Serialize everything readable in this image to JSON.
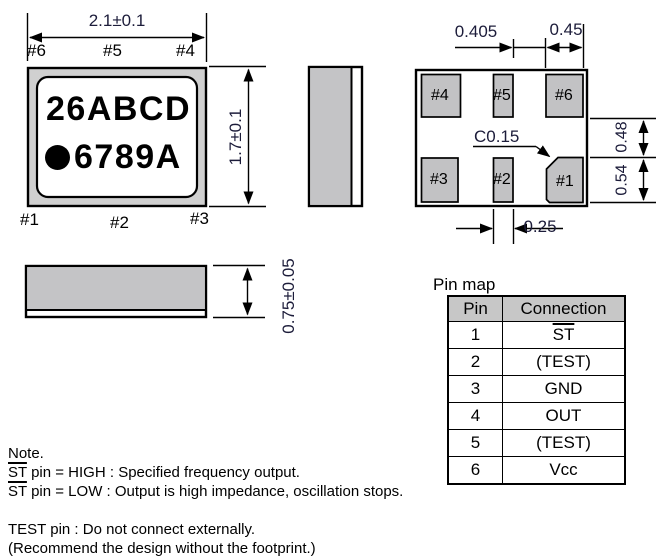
{
  "top_view": {
    "dim_width": "2.1±0.1",
    "dim_height": "1.7±0.1",
    "marking_line1": "26ABCD",
    "marking_line2": "6789A",
    "pins_top": [
      "#6",
      "#5",
      "#4"
    ],
    "pins_bottom": [
      "#1",
      "#2",
      "#3"
    ]
  },
  "side_view": {
    "dim_thickness": "0.75±0.05"
  },
  "bottom_view": {
    "dim_pad_gap": "0.405",
    "dim_pad6_width": "0.45",
    "dim_chamfer": "C0.15",
    "dim_pad2_width": "0.25",
    "dim_row_gap": "0.48",
    "dim_pad_height": "0.54",
    "pads": {
      "p1": "#1",
      "p2": "#2",
      "p3": "#3",
      "p4": "#4",
      "p5": "#5",
      "p6": "#6"
    }
  },
  "pin_map": {
    "title": "Pin map",
    "headers": [
      "Pin",
      "Connection"
    ],
    "rows": [
      [
        "1",
        "ST"
      ],
      [
        "2",
        "(TEST)"
      ],
      [
        "3",
        "GND"
      ],
      [
        "4",
        "OUT"
      ],
      [
        "5",
        "(TEST)"
      ],
      [
        "6",
        "Vcc"
      ]
    ]
  },
  "notes": {
    "title": "Note.",
    "st": "ST",
    "st_high_rest": " pin = HIGH : Specified frequency output.",
    "st_low_rest": " pin = LOW : Output is high impedance, oscillation stops.",
    "test_line1": "TEST pin : Do not connect externally.",
    "test_line2": "(Recommend the design without the footprint.)"
  }
}
